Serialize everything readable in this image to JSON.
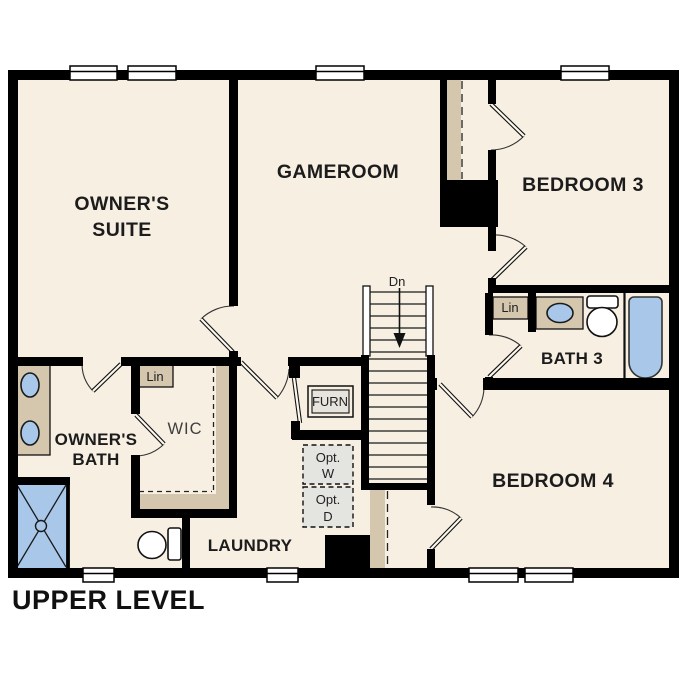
{
  "title": "UPPER LEVEL",
  "rooms": {
    "owners_suite": {
      "line1": "OWNER'S",
      "line2": "SUITE"
    },
    "gameroom": "GAMEROOM",
    "bedroom3": "BEDROOM 3",
    "bath3": "BATH 3",
    "bedroom4": "BEDROOM 4",
    "owners_bath": {
      "line1": "OWNER'S",
      "line2": "BATH"
    },
    "wic": "WIC",
    "laundry": "LAUNDRY"
  },
  "closets": {
    "lin_wic": "Lin",
    "lin_bath3": "Lin"
  },
  "equipment": {
    "furnace": "FURN",
    "opt_washer": {
      "line1": "Opt.",
      "line2": "W"
    },
    "opt_dryer": {
      "line1": "Opt.",
      "line2": "D"
    }
  },
  "stairs": {
    "direction": "Dn"
  },
  "colors": {
    "floor": "#f7efe2",
    "wall": "#000000",
    "casework": "#d5c7ae",
    "fixture_blue": "#a9c8e9",
    "optional_fill": "#e4e4e1",
    "furn_fill": "#e7e4de"
  }
}
